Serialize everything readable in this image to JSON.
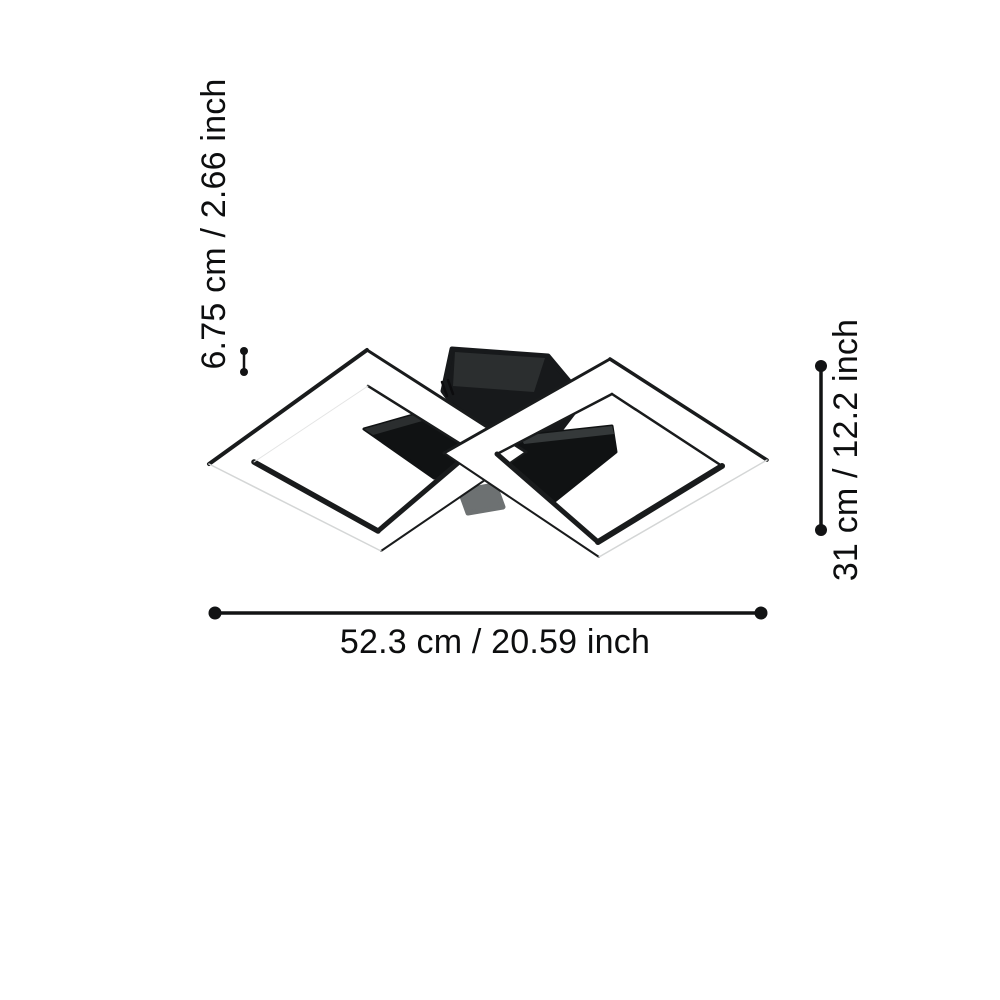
{
  "page": {
    "background_color": "#ffffff"
  },
  "product": {
    "name": "LED ceiling light with two crossed square frames",
    "frame_face_color": "#ffffff",
    "frame_edge_color": "#191b1c",
    "frame_edge_light_color": "#d4d6d6",
    "canopy_color": "#17191b",
    "canopy_highlight_color": "#2b2e2f",
    "driver_color": "#101213",
    "driver_highlight_color": "#35393a",
    "connector_color": "#6d7172"
  },
  "dimensions": {
    "line_color": "#121314",
    "width_label": "52.3 cm / 20.59 inch",
    "height_label": "31 cm / 12.2 inch",
    "depth_label": "6.75 cm / 2.66 inch"
  }
}
